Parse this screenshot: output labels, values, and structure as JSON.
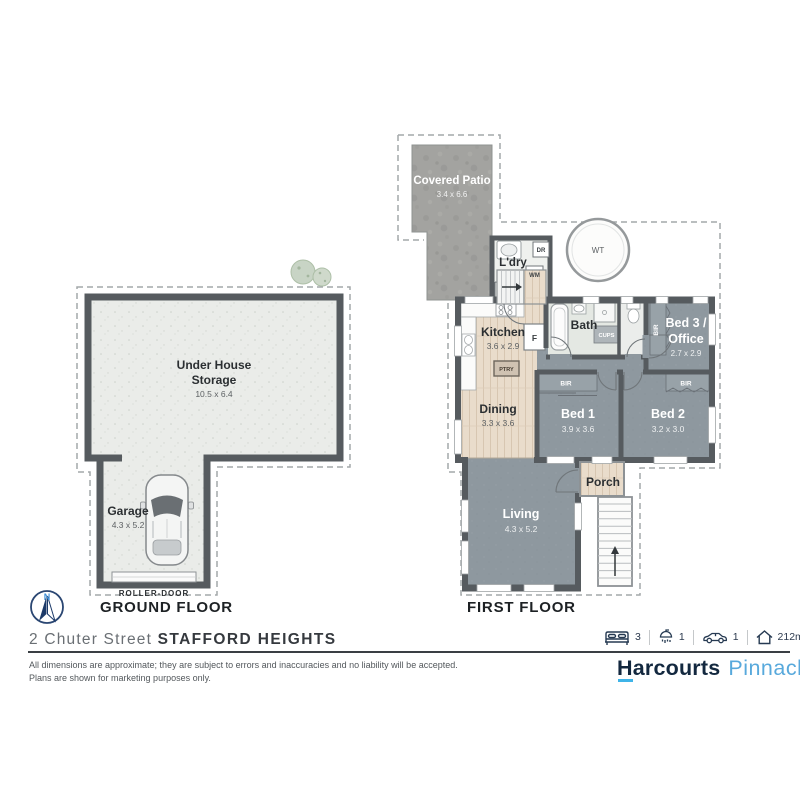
{
  "address": {
    "street": "2 Chuter Street",
    "suburb": "STAFFORD HEIGHTS"
  },
  "disclaimer": {
    "line1": "All dimensions are approximate; they are subject to errors and inaccuracies and no liability will be accepted.",
    "line2": "Plans are shown for marketing purposes only."
  },
  "stats": {
    "beds": "3",
    "baths": "1",
    "cars": "1",
    "area": "212m²"
  },
  "branding": {
    "primary": "Harcourts",
    "secondary": "Pinnacle"
  },
  "compass": {
    "north": "N"
  },
  "floors": {
    "ground": {
      "label": "GROUND FLOOR",
      "storage": {
        "name1": "Under House",
        "name2": "Storage",
        "dims": "10.5 x 6.4"
      },
      "garage": {
        "name": "Garage",
        "dims": "4.3 x 5.2",
        "door": "ROLLER-DOOR"
      }
    },
    "first": {
      "label": "FIRST FLOOR",
      "patio": {
        "name": "Covered Patio",
        "dims": "3.4 x 6.6"
      },
      "water_tank": {
        "label": "WT"
      },
      "laundry": {
        "name": "L'dry",
        "dryer": "DR",
        "washer": "WM"
      },
      "kitchen": {
        "name": "Kitchen",
        "dims": "3.6 x 2.9",
        "fridge": "F",
        "pantry": "PTRY"
      },
      "bath": {
        "name": "Bath",
        "cupboard": "CUPS"
      },
      "bed3": {
        "name1": "Bed 3 /",
        "name2": "Office",
        "dims": "2.7 x 2.9",
        "robe": "BIR"
      },
      "dining": {
        "name": "Dining",
        "dims": "3.3 x 3.6"
      },
      "bed1": {
        "name": "Bed 1",
        "dims": "3.9 x 3.6",
        "robe": "BIR"
      },
      "bed2": {
        "name": "Bed 2",
        "dims": "3.2 x 3.0",
        "robe": "BIR"
      },
      "porch": {
        "name": "Porch"
      },
      "living": {
        "name": "Living",
        "dims": "4.3 x 5.2"
      }
    }
  },
  "colors": {
    "wall": "#565b5f",
    "room_gray": "#8e989f",
    "wood": "#e9dccb",
    "patio_concrete": "#a3a3a0",
    "accent_navy": "#13283f",
    "accent_blue": "#58a9dc"
  }
}
